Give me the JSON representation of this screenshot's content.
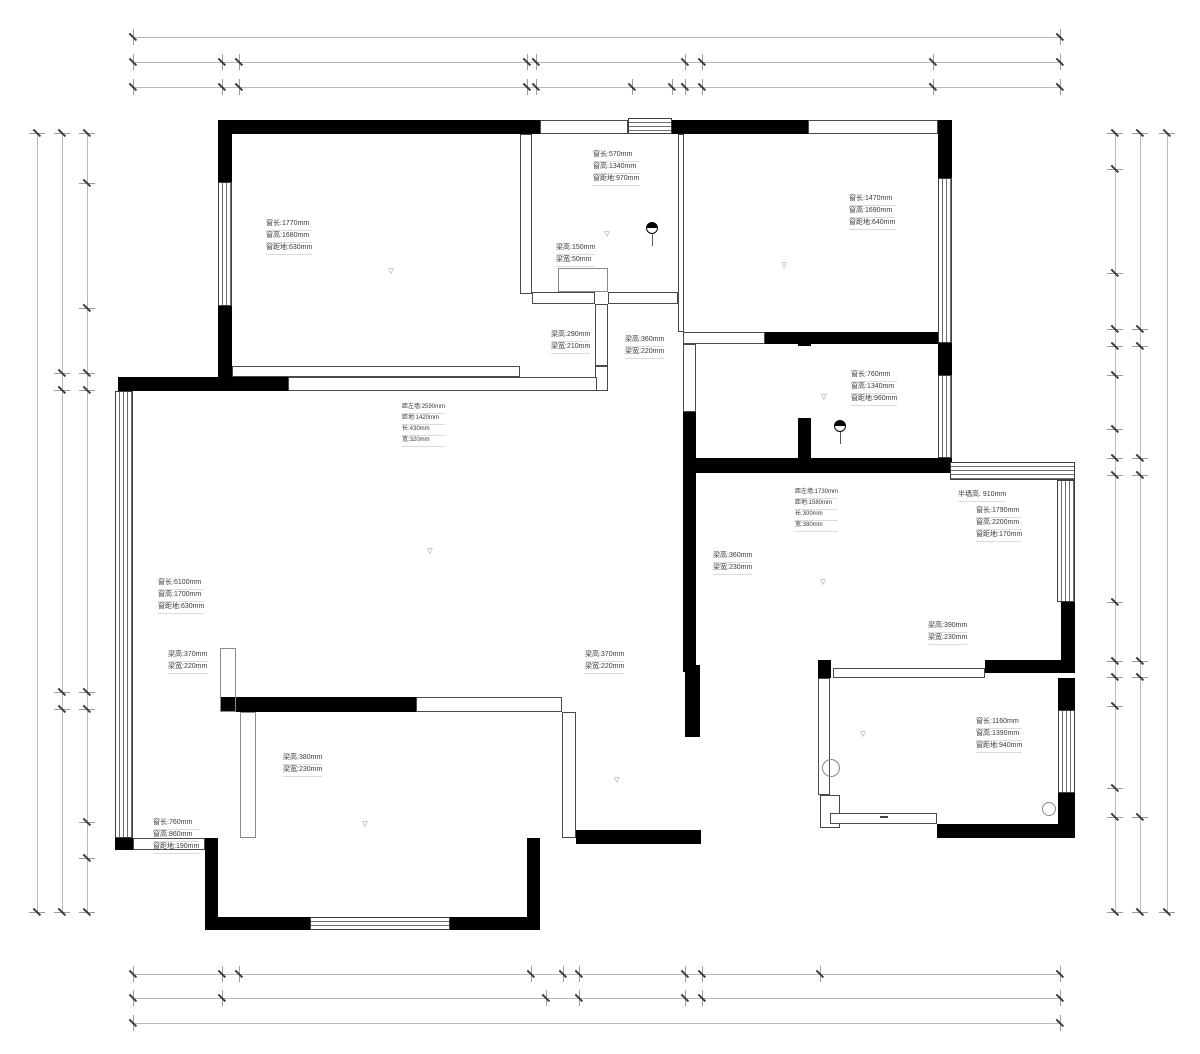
{
  "meta": {
    "width": 1200,
    "height": 1054,
    "bg": "#ffffff",
    "wall_color": "#000000",
    "dim_line_color": "#b9b9b9",
    "text_color": "#3a3a3a"
  },
  "dim_chains": [
    {
      "id": "top-total",
      "orient": "h",
      "pos": 37,
      "segments": [
        {
          "from": 133,
          "to": 1060,
          "label": "13070"
        }
      ]
    },
    {
      "id": "top-row2",
      "orient": "h",
      "pos": 62,
      "segments": [
        {
          "from": 133,
          "to": 222,
          "label": "1260"
        },
        {
          "from": 239,
          "to": 527,
          "label": "4070"
        },
        {
          "from": 536,
          "to": 685,
          "label": "2100"
        },
        {
          "from": 702,
          "to": 933,
          "label": "3270"
        },
        {
          "from": 933,
          "to": 1060,
          "label": "1780"
        }
      ]
    },
    {
      "id": "top-row3",
      "orient": "h",
      "pos": 87,
      "segments": [
        {
          "from": 133,
          "to": 222,
          "label": "1260"
        },
        {
          "from": 222,
          "to": 239,
          "label": "230"
        },
        {
          "from": 239,
          "to": 527,
          "label": "4070"
        },
        {
          "from": 527,
          "to": 536,
          "label": "130"
        },
        {
          "from": 536,
          "to": 632,
          "label": "1350"
        },
        {
          "from": 632,
          "to": 672,
          "label": "570"
        },
        {
          "from": 672,
          "to": 685,
          "label": "180"
        },
        {
          "from": 685,
          "to": 702,
          "label": "230"
        },
        {
          "from": 702,
          "to": 933,
          "label": "3270"
        },
        {
          "from": 933,
          "to": 1060,
          "label": "1780"
        }
      ]
    },
    {
      "id": "bottom-row1",
      "orient": "h",
      "pos": 974,
      "segments": [
        {
          "from": 133,
          "to": 222,
          "label": "1260"
        },
        {
          "from": 222,
          "to": 239,
          "label": "230"
        },
        {
          "from": 239,
          "to": 531,
          "label": "4120"
        },
        {
          "from": 531,
          "to": 563,
          "label": "450"
        },
        {
          "from": 563,
          "to": 579,
          "label": "230"
        },
        {
          "from": 579,
          "to": 685,
          "label": "1500"
        },
        {
          "from": 685,
          "to": 702,
          "label": "240"
        },
        {
          "from": 702,
          "to": 820,
          "label": "1660"
        },
        {
          "from": 820,
          "to": 1060,
          "label": "3380"
        }
      ]
    },
    {
      "id": "bottom-row2",
      "orient": "h",
      "pos": 998,
      "segments": [
        {
          "from": 133,
          "to": 222,
          "label": "1260"
        },
        {
          "from": 222,
          "to": 546,
          "label": "4570"
        },
        {
          "from": 579,
          "to": 685,
          "label": "1500"
        },
        {
          "from": 702,
          "to": 1060,
          "label": "5040"
        }
      ]
    },
    {
      "id": "bottom-total",
      "orient": "h",
      "pos": 1023,
      "segments": [
        {
          "from": 133,
          "to": 1060,
          "label": "13070"
        }
      ]
    },
    {
      "id": "left-inner",
      "orient": "v",
      "pos": 87,
      "segments": [
        {
          "from": 133,
          "to": 183,
          "label": "700"
        },
        {
          "from": 183,
          "to": 308,
          "label": "1770"
        },
        {
          "from": 308,
          "to": 373,
          "label": "910"
        },
        {
          "from": 373,
          "to": 390,
          "label": "240"
        },
        {
          "from": 390,
          "to": 692,
          "label": "4260"
        },
        {
          "from": 692,
          "to": 709,
          "label": "240"
        },
        {
          "from": 709,
          "to": 822,
          "label": "1600"
        },
        {
          "from": 822,
          "to": 858,
          "label": "510"
        },
        {
          "from": 858,
          "to": 912,
          "label": "760"
        }
      ]
    },
    {
      "id": "left-middle",
      "orient": "v",
      "pos": 62,
      "segments": [
        {
          "from": 133,
          "to": 373,
          "label": "3380"
        },
        {
          "from": 390,
          "to": 692,
          "label": "4260"
        },
        {
          "from": 709,
          "to": 912,
          "label": "2870"
        }
      ]
    },
    {
      "id": "left-outer",
      "orient": "v",
      "pos": 37,
      "segments": [
        {
          "from": 133,
          "to": 912,
          "label": "10990"
        }
      ]
    },
    {
      "id": "right-inner",
      "orient": "v",
      "pos": 1115,
      "segments": [
        {
          "from": 133,
          "to": 169,
          "label": "500"
        },
        {
          "from": 169,
          "to": 273,
          "label": "1470"
        },
        {
          "from": 273,
          "to": 329,
          "label": "800"
        },
        {
          "from": 329,
          "to": 346,
          "label": "240"
        },
        {
          "from": 346,
          "to": 375,
          "label": "400"
        },
        {
          "from": 375,
          "to": 429,
          "label": "760"
        },
        {
          "from": 429,
          "to": 458,
          "label": "410"
        },
        {
          "from": 458,
          "to": 475,
          "label": "240"
        },
        {
          "from": 475,
          "to": 602,
          "label": "1800"
        },
        {
          "from": 602,
          "to": 661,
          "label": "820"
        },
        {
          "from": 661,
          "to": 677,
          "label": "230"
        },
        {
          "from": 677,
          "to": 706,
          "label": "410"
        },
        {
          "from": 706,
          "to": 788,
          "label": "1160"
        },
        {
          "from": 788,
          "to": 817,
          "label": "400"
        },
        {
          "from": 817,
          "to": 912,
          "label": "1350"
        }
      ]
    },
    {
      "id": "right-middle",
      "orient": "v",
      "pos": 1140,
      "segments": [
        {
          "from": 133,
          "to": 329,
          "label": "2770"
        },
        {
          "from": 346,
          "to": 458,
          "label": "1570"
        },
        {
          "from": 475,
          "to": 661,
          "label": "2620"
        },
        {
          "from": 677,
          "to": 817,
          "label": "1970"
        },
        {
          "from": 817,
          "to": 912,
          "label": "1350"
        }
      ]
    },
    {
      "id": "right-outer",
      "orient": "v",
      "pos": 1167,
      "segments": [
        {
          "from": 133,
          "to": 912,
          "label": "10990"
        }
      ]
    }
  ],
  "walls": [
    [
      218,
      120,
      322,
      14
    ],
    [
      672,
      120,
      136,
      14
    ],
    [
      938,
      120,
      14,
      58
    ],
    [
      218,
      134,
      14,
      48
    ],
    [
      218,
      306,
      14,
      71
    ],
    [
      118,
      377,
      170,
      14
    ],
    [
      938,
      343,
      14,
      32
    ],
    [
      765,
      332,
      173,
      12
    ],
    [
      683,
      458,
      255,
      15
    ],
    [
      683,
      412,
      13,
      46
    ],
    [
      798,
      332,
      13,
      14
    ],
    [
      798,
      418,
      13,
      40
    ],
    [
      220,
      697,
      196,
      15
    ],
    [
      205,
      838,
      13,
      92
    ],
    [
      218,
      917,
      92,
      13
    ],
    [
      450,
      917,
      90,
      13
    ],
    [
      527,
      838,
      13,
      92
    ],
    [
      683,
      473,
      13,
      199
    ],
    [
      685,
      665,
      15,
      72
    ],
    [
      685,
      830,
      16,
      14
    ],
    [
      576,
      830,
      125,
      14
    ],
    [
      818,
      660,
      13,
      18
    ],
    [
      985,
      660,
      90,
      13
    ],
    [
      1061,
      602,
      14,
      58
    ],
    [
      1058,
      678,
      17,
      32
    ],
    [
      1058,
      793,
      17,
      37
    ],
    [
      937,
      824,
      138,
      14
    ],
    [
      115,
      838,
      18,
      12
    ],
    [
      938,
      458,
      14,
      15
    ]
  ],
  "thin_walls": [
    [
      540,
      120,
      88,
      14
    ],
    [
      808,
      120,
      130,
      14
    ],
    [
      520,
      134,
      12,
      160
    ],
    [
      532,
      292,
      63,
      12
    ],
    [
      608,
      292,
      70,
      12
    ],
    [
      595,
      304,
      13,
      62
    ],
    [
      595,
      366,
      13,
      25
    ],
    [
      232,
      366,
      288,
      11
    ],
    [
      288,
      377,
      309,
      14
    ],
    [
      678,
      134,
      6,
      198
    ],
    [
      683,
      332,
      82,
      12
    ],
    [
      683,
      344,
      13,
      68
    ],
    [
      416,
      697,
      146,
      15
    ],
    [
      562,
      712,
      14,
      126
    ],
    [
      133,
      838,
      72,
      12
    ],
    [
      833,
      668,
      152,
      10
    ],
    [
      818,
      678,
      12,
      117
    ],
    [
      820,
      795,
      20,
      33
    ],
    [
      830,
      813,
      107,
      11
    ]
  ],
  "beams": [
    [
      220,
      648,
      16,
      64
    ],
    [
      240,
      712,
      16,
      126
    ],
    [
      558,
      268,
      50,
      24
    ]
  ],
  "windows": [
    {
      "x": 218,
      "y": 182,
      "w": 14,
      "h": 124,
      "dir": "v"
    },
    {
      "x": 115,
      "y": 391,
      "w": 18,
      "h": 447,
      "dir": "v"
    },
    {
      "x": 310,
      "y": 917,
      "w": 140,
      "h": 13,
      "dir": "h"
    },
    {
      "x": 938,
      "y": 178,
      "w": 14,
      "h": 165,
      "dir": "v"
    },
    {
      "x": 938,
      "y": 375,
      "w": 14,
      "h": 83,
      "dir": "v"
    },
    {
      "x": 950,
      "y": 462,
      "w": 125,
      "h": 18,
      "dir": "h"
    },
    {
      "x": 1057,
      "y": 480,
      "w": 18,
      "h": 122,
      "dir": "v"
    },
    {
      "x": 1058,
      "y": 710,
      "w": 17,
      "h": 83,
      "dir": "v"
    },
    {
      "x": 628,
      "y": 118,
      "w": 44,
      "h": 16,
      "dir": "h"
    }
  ],
  "annotations": [
    {
      "x": 266,
      "y": 219,
      "size": 7,
      "lines": [
        "窗长:1770mm",
        "窗高:1680mm",
        "窗距地:630mm"
      ]
    },
    {
      "x": 593,
      "y": 150,
      "size": 7,
      "lines": [
        "窗长:570mm",
        "窗高:1340mm",
        "窗距地:970mm"
      ]
    },
    {
      "x": 849,
      "y": 194,
      "size": 7,
      "lines": [
        "窗长:1470mm",
        "窗高:1690mm",
        "窗距地:640mm"
      ]
    },
    {
      "x": 556,
      "y": 243,
      "size": 7,
      "lines": [
        "梁高:150mm",
        "梁宽:50mm"
      ]
    },
    {
      "x": 551,
      "y": 330,
      "size": 7,
      "lines": [
        "梁高:290mm",
        "梁宽:210mm"
      ]
    },
    {
      "x": 625,
      "y": 335,
      "size": 7,
      "lines": [
        "梁高:360mm",
        "梁宽:220mm"
      ]
    },
    {
      "x": 851,
      "y": 370,
      "size": 7,
      "lines": [
        "窗长:760mm",
        "窗高:1340mm",
        "窗距地:960mm"
      ]
    },
    {
      "x": 402,
      "y": 403,
      "size": 6,
      "lines": [
        "距左墙:2590mm",
        "距地:1420mm",
        "长:430mm",
        "宽:320mm"
      ]
    },
    {
      "x": 795,
      "y": 488,
      "size": 6,
      "lines": [
        "距左墙:1730mm",
        "距地:1580mm",
        "长:300mm",
        "宽:380mm"
      ]
    },
    {
      "x": 958,
      "y": 490,
      "size": 7,
      "lines": [
        "半墙高: 910mm"
      ]
    },
    {
      "x": 976,
      "y": 506,
      "size": 7,
      "lines": [
        "窗长:1790mm",
        "窗高:2200mm",
        "窗距地:170mm"
      ]
    },
    {
      "x": 158,
      "y": 578,
      "size": 7,
      "lines": [
        "窗长:6100mm",
        "窗高:1700mm",
        "窗距地:630mm"
      ]
    },
    {
      "x": 713,
      "y": 551,
      "size": 7,
      "lines": [
        "梁高:360mm",
        "梁宽:230mm"
      ]
    },
    {
      "x": 928,
      "y": 621,
      "size": 7,
      "lines": [
        "梁高:390mm",
        "梁宽:230mm"
      ]
    },
    {
      "x": 168,
      "y": 650,
      "size": 7,
      "lines": [
        "梁高:370mm",
        "梁宽:220mm"
      ]
    },
    {
      "x": 585,
      "y": 650,
      "size": 7,
      "lines": [
        "梁高:370mm",
        "梁宽:220mm"
      ]
    },
    {
      "x": 283,
      "y": 753,
      "size": 7,
      "lines": [
        "梁高:380mm",
        "梁宽:230mm"
      ]
    },
    {
      "x": 153,
      "y": 818,
      "size": 7,
      "lines": [
        "窗长:760mm",
        "窗高:860mm",
        "窗距地:190mm"
      ]
    },
    {
      "x": 976,
      "y": 717,
      "size": 7,
      "lines": [
        "窗长:1160mm",
        "窗高:1390mm",
        "窗距地:940mm"
      ]
    }
  ],
  "room_labels": [
    {
      "text": "2.730",
      "x": 397,
      "y": 263
    },
    {
      "text": "2.710",
      "x": 613,
      "y": 226
    },
    {
      "text": "2.730",
      "x": 790,
      "y": 257
    },
    {
      "text": "2.750",
      "x": 830,
      "y": 389
    },
    {
      "text": "2.700",
      "x": 436,
      "y": 543
    },
    {
      "text": "2.720",
      "x": 829,
      "y": 574
    },
    {
      "text": "2.740",
      "x": 869,
      "y": 726
    },
    {
      "text": "2.730",
      "x": 623,
      "y": 772
    },
    {
      "text": "2.720",
      "x": 371,
      "y": 816
    }
  ],
  "rotated_labels": [
    {
      "text": "门洞: 2300mm",
      "x": 601,
      "y": 335,
      "size": 8
    },
    {
      "text": "门洞: 2300mm",
      "x": 790,
      "y": 383,
      "size": 8
    },
    {
      "text": "门洞: 2300mm",
      "x": 551,
      "y": 750,
      "size": 8
    },
    {
      "text": "门洞: 2100mm",
      "x": 679,
      "y": 770,
      "size": 8
    },
    {
      "text": "-R--J-",
      "x": 676,
      "y": 165,
      "size": 7
    },
    {
      "text": "-R--J-",
      "x": 1051,
      "y": 730,
      "size": 7
    }
  ],
  "flat_labels": [
    {
      "text": "-R--J-",
      "x": 560,
      "y": 142,
      "size": 7
    },
    {
      "text": "-R--J-",
      "x": 903,
      "y": 356,
      "size": 7
    },
    {
      "text": "-R--J-",
      "x": 755,
      "y": 450,
      "size": 7,
      "rot": 180
    },
    {
      "text": "-R--J-",
      "x": 1039,
      "y": 687,
      "size": 7
    },
    {
      "text": "新风管",
      "x": 861,
      "y": 768,
      "size": 9
    },
    {
      "text": "G",
      "x": 1007,
      "y": 808,
      "size": 8
    },
    {
      "text": "DIS",
      "x": 884,
      "y": 817,
      "size": 8,
      "box": true
    }
  ],
  "wall_tags": [
    {
      "text": "弱电箱",
      "x": 404,
      "y": 384
    },
    {
      "text": "电表箱",
      "x": 800,
      "y": 473
    }
  ],
  "icons": [
    {
      "type": "half",
      "x": 652,
      "y": 228,
      "r": 6
    },
    {
      "type": "half",
      "x": 840,
      "y": 426,
      "r": 6
    },
    {
      "type": "circle",
      "x": 831,
      "y": 768,
      "r": 9
    },
    {
      "type": "circle",
      "x": 1049,
      "y": 809,
      "r": 7
    }
  ]
}
